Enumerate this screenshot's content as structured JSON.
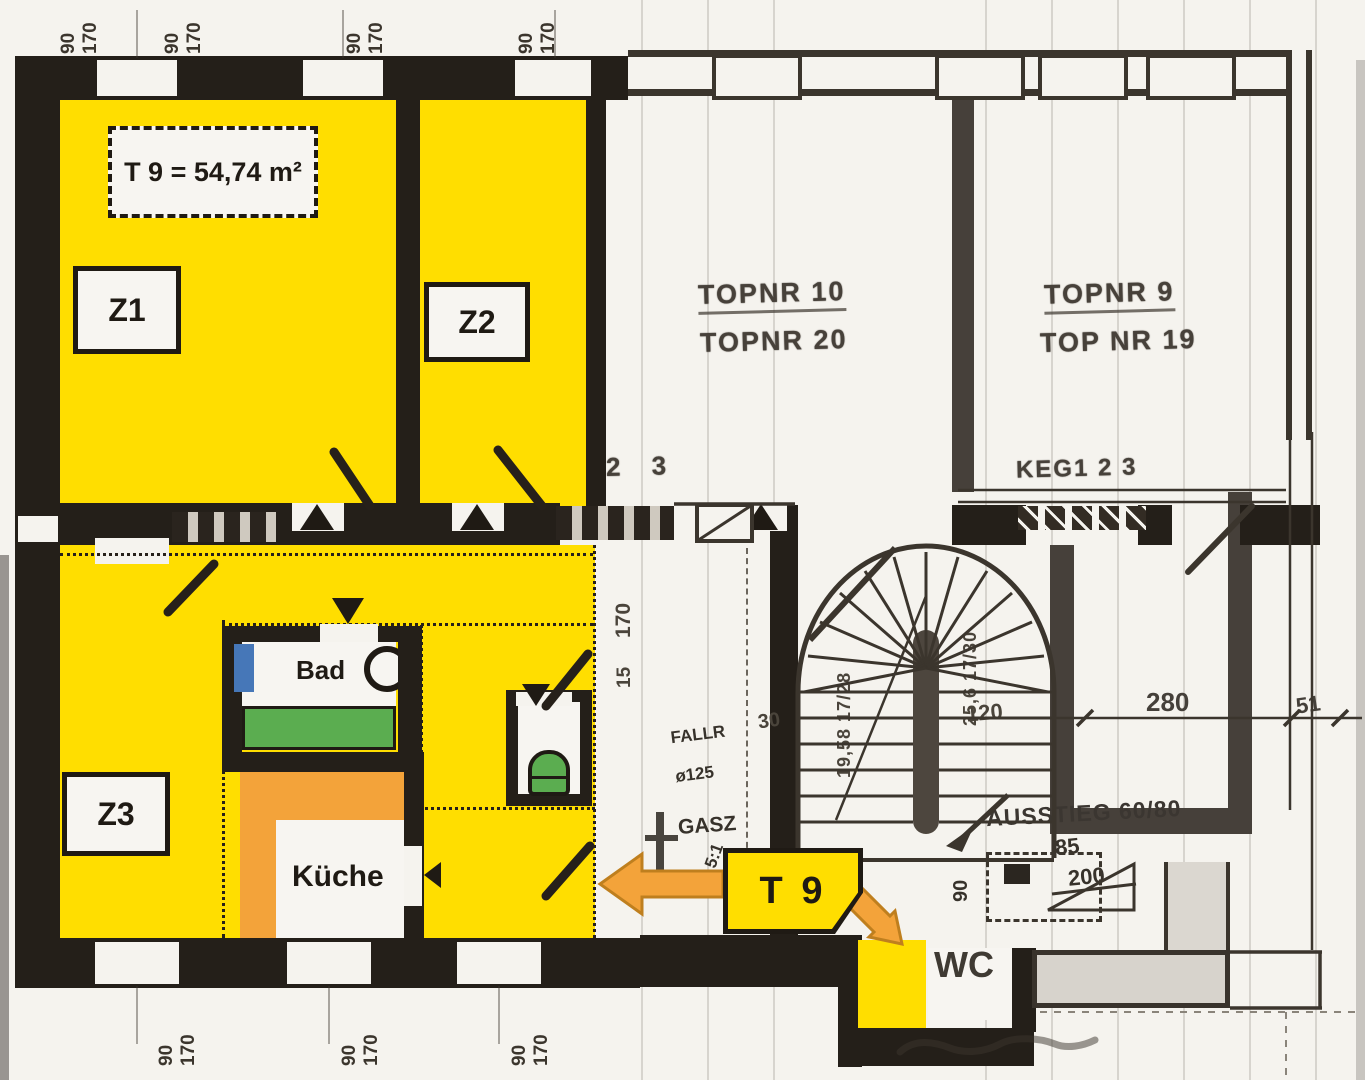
{
  "unit": {
    "area_label": "T 9 = 54,74 m²",
    "tag": "T 9"
  },
  "rooms": {
    "z1": "Z1",
    "z2": "Z2",
    "z3": "Z3",
    "bad": "Bad",
    "kueche": "Küche",
    "wc": "WC"
  },
  "neighbors": {
    "left_unit_line1": "TOPNR 10",
    "left_unit_line2": "TOPNR 20",
    "right_unit_line1": "TOPNR 9",
    "right_unit_line2": "TOP NR 19",
    "keller_note": "KEG1 2 3",
    "pencil_note": "2 3"
  },
  "annotations": {
    "ausstieg": "AUSSTIEG 60/80",
    "gasz": "GASZ",
    "fallr_line1": "FALLR",
    "fallr_line2": "ø125",
    "ratio_note": "5:1"
  },
  "dims": {
    "d280": "280",
    "d51": "51",
    "d85": "85",
    "d200": "200",
    "d120": "120",
    "d30": "30",
    "d170": "170",
    "d15": "15",
    "d90": "90",
    "win_w": "90",
    "win_h": "170",
    "stair_left": "19,58 17/28",
    "stair_right": "25,6 17/30"
  },
  "colors": {
    "highlight_yellow": "#FFDE00",
    "accent_orange": "#F3A33A",
    "fixture_green": "#5BAD50",
    "window_blue": "#4677B8",
    "wall_dark": "#241F19",
    "paper": "#F5F3EE",
    "ink": "#3B352D"
  }
}
